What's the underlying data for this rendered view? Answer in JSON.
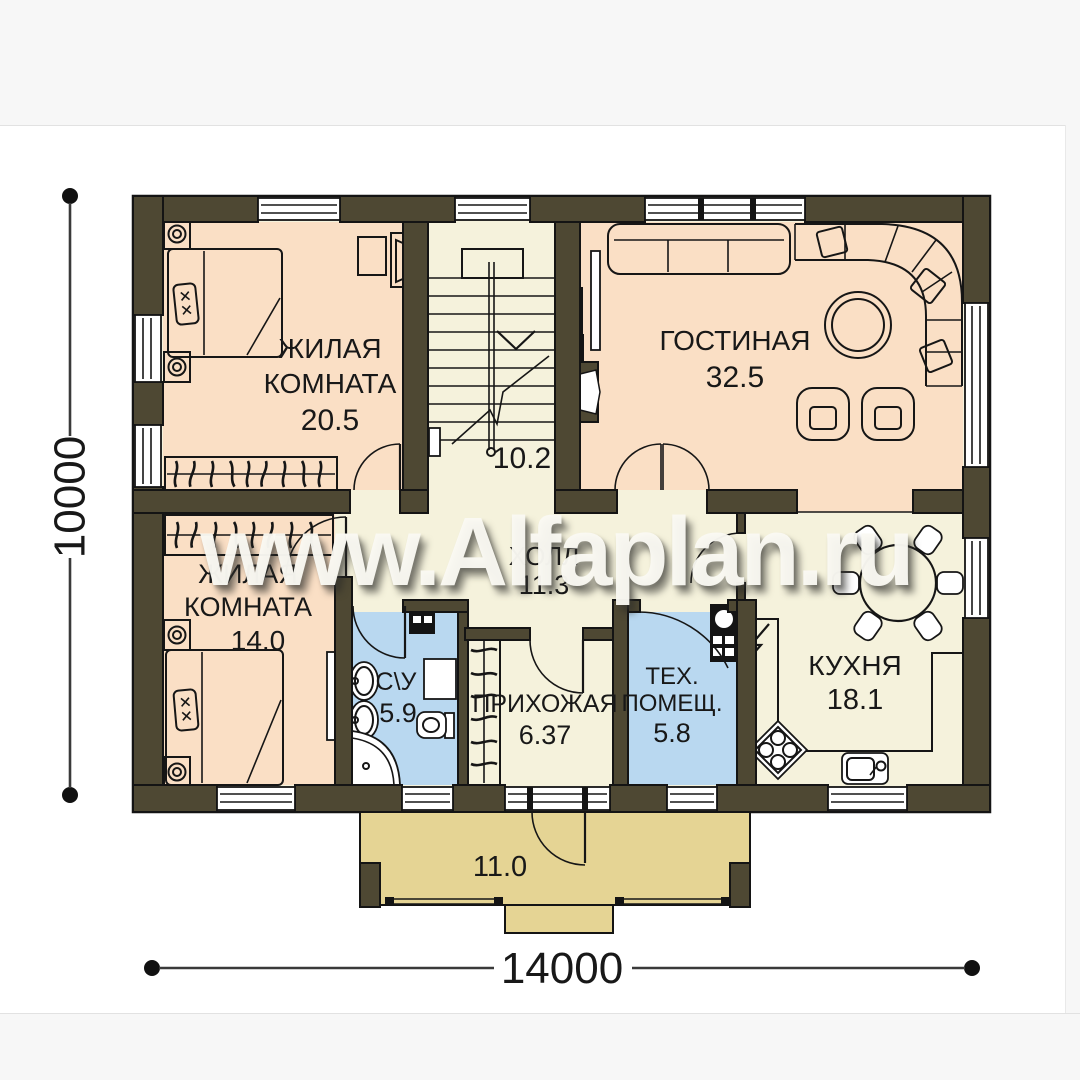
{
  "watermark": {
    "text": "www.Alfaplan.ru"
  },
  "dimensions": {
    "height_label": "10000",
    "width_label": "14000"
  },
  "rooms": {
    "bedroom1": {
      "name_line1": "ЖИЛАЯ",
      "name_line2": "КОМНАТА",
      "area": "20.5"
    },
    "living_room": {
      "name": "ГОСТИНАЯ",
      "area": "32.5"
    },
    "stairs": {
      "area": "10.2"
    },
    "bedroom2": {
      "name_line1": "ЖИЛАЯ",
      "name_line2": "КОМНАТА",
      "area": "14.0"
    },
    "hall": {
      "name": "ХОЛЛ",
      "area": "11.3"
    },
    "bathroom": {
      "name": "С\\У",
      "area": "5.9"
    },
    "entry_hall": {
      "name": "ПРИХОЖАЯ",
      "area": "6.37"
    },
    "tech_room": {
      "name_line1": "ТЕХ.",
      "name_line2": "ПОМЕЩ.",
      "area": "5.8"
    },
    "kitchen": {
      "name": "КУХНЯ",
      "area": "18.1"
    },
    "terrace": {
      "area": "11.0"
    }
  },
  "colors": {
    "wall": "#4e4833",
    "room-peach": "#fadfc5",
    "room-blue": "#b9d8f0",
    "room-cream": "#f5f2dc",
    "terrace-tan": "#e5d494",
    "band": "#f7f7f7"
  }
}
